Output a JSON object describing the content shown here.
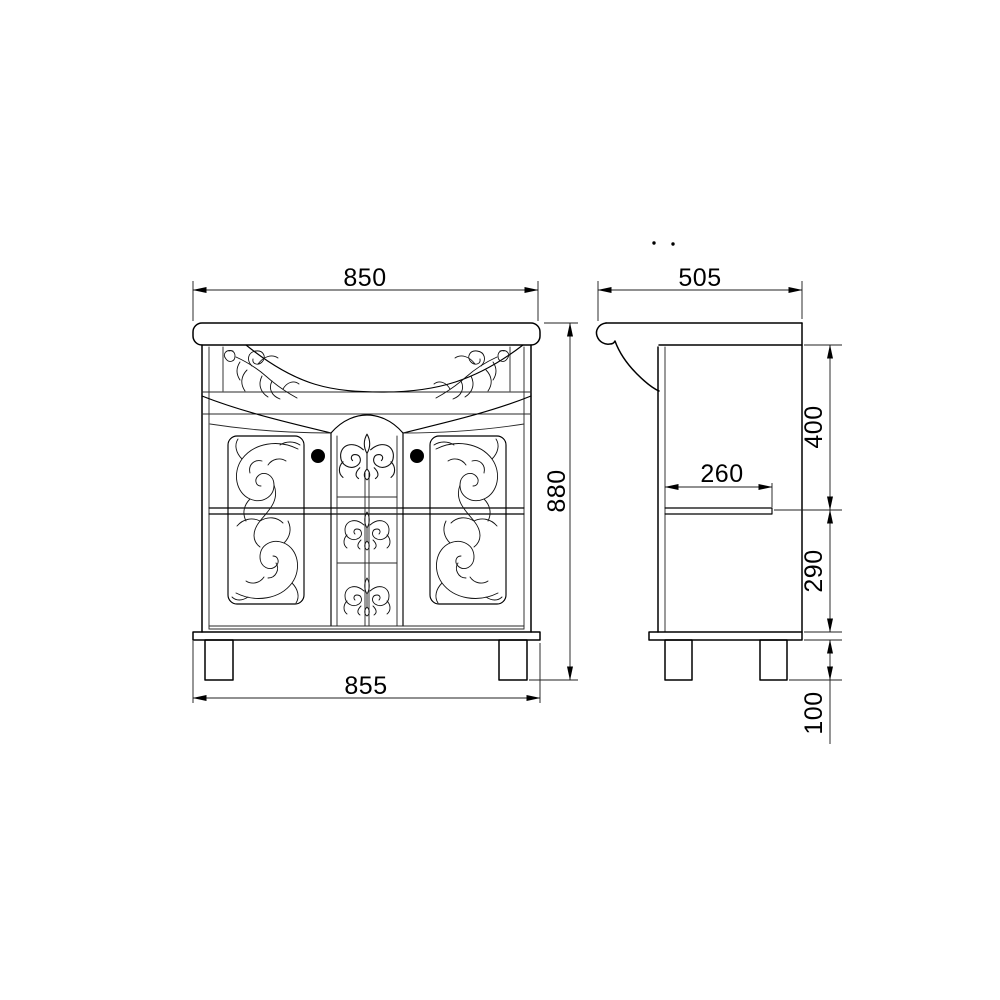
{
  "drawing": {
    "front_view": {
      "dim_width_top": "850",
      "dim_height": "880",
      "dim_width_bottom": "855"
    },
    "side_view": {
      "dim_depth": "505",
      "dim_shelf_depth": "260",
      "dim_upper_height": "400",
      "dim_lower_height": "290",
      "dim_leg_height": "100"
    },
    "style": {
      "line_color": "#000000",
      "background_color": "#ffffff"
    }
  }
}
